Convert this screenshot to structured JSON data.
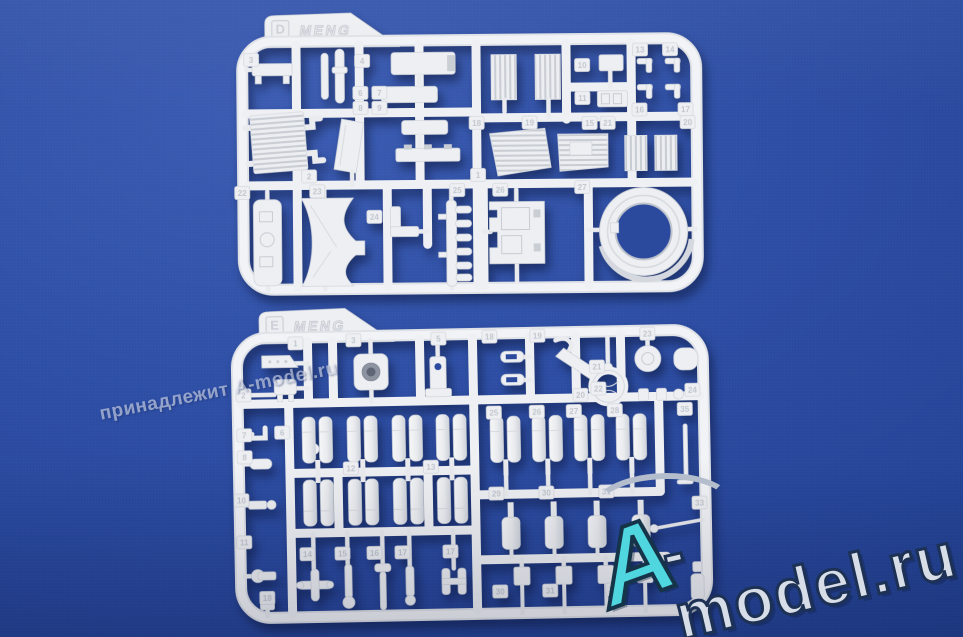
{
  "scene": {
    "description": "Photo of two white MENG plastic model kit sprues (runners D and E) with numbered parts, lying on a blue fabric background",
    "background_color": "#2e4fa6",
    "plastic_color": "#edeff2"
  },
  "watermarks": {
    "diagonal_text": "принадлежит A-model.ru",
    "logo": {
      "a": "A",
      "rest": "-model.ru"
    }
  },
  "sprues": {
    "d": {
      "letter": "D",
      "brand": "MENG",
      "tags": [
        "3",
        "4",
        "6",
        "7",
        "8",
        "9",
        "2",
        "1",
        "10",
        "11",
        "13",
        "14",
        "16",
        "17",
        "15",
        "21",
        "20",
        "18",
        "19",
        "22",
        "23",
        "24",
        "25",
        "26",
        "27"
      ]
    },
    "e": {
      "letter": "E",
      "brand": "MENG",
      "tags": [
        "1",
        "3",
        "2",
        "5",
        "18",
        "19",
        "23",
        "21",
        "22",
        "20",
        "24",
        "7",
        "6",
        "8",
        "10",
        "11",
        "12",
        "13",
        "14",
        "15",
        "16",
        "17",
        "17",
        "25",
        "26",
        "27",
        "28",
        "35",
        "29",
        "30",
        "31",
        "30",
        "31",
        "32",
        "33",
        "18"
      ]
    }
  }
}
